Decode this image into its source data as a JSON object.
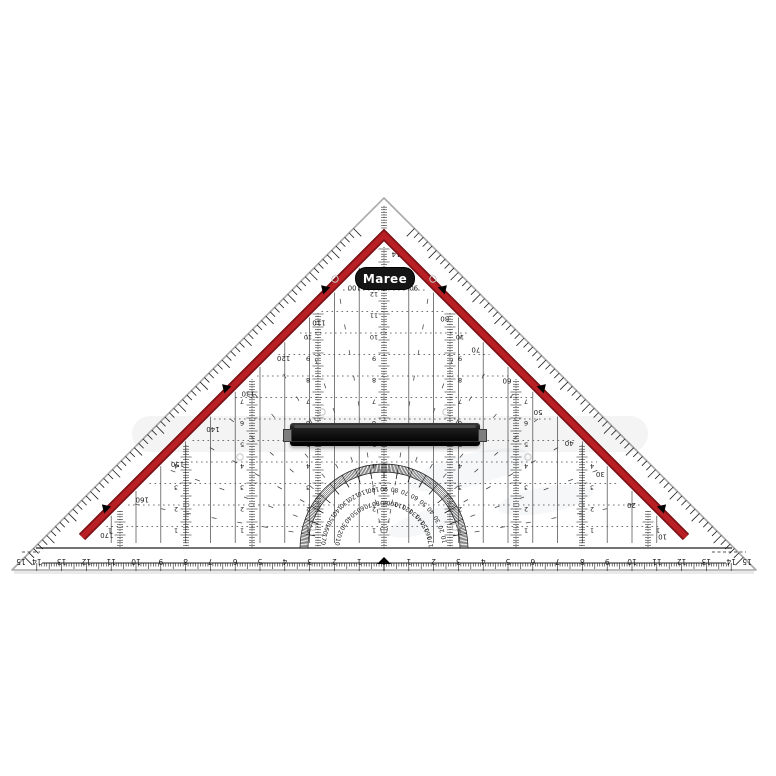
{
  "scene": {
    "background": "#ffffff",
    "description": "Transparent Maree geometry set square (protractor triangle) with black removable handle on white background"
  },
  "logo": {
    "text": "Maree",
    "bg": "#151515",
    "fg": "#ffffff"
  },
  "colors": {
    "band_red": "#b92025",
    "band_red_dark": "#7c1014",
    "print": "#1c1c1c",
    "print_soft": "#454545",
    "plastic_edge": "#a9a9a9",
    "handle": "#141414",
    "shadow": "#e3e3e3",
    "circle": "#c4c4c4"
  },
  "hypotenuse_ruler": {
    "unit": "cm",
    "numbers": [
      15,
      14,
      13,
      12,
      11,
      10,
      9,
      8,
      7,
      6,
      5,
      4,
      3,
      2,
      1,
      0,
      1,
      2,
      3,
      4,
      5,
      6,
      7,
      8,
      9,
      10,
      11,
      12,
      13,
      14,
      15
    ],
    "zero_marker": true
  },
  "leg_scales": {
    "right_labels": [
      90,
      80,
      70,
      60,
      50,
      40,
      30,
      20,
      10
    ],
    "left_labels": [
      100,
      110,
      120,
      130,
      140,
      150,
      160,
      170
    ]
  },
  "protractor": {
    "outer_scale": [
      10,
      20,
      30,
      40,
      50,
      60,
      70,
      80,
      90,
      100,
      110,
      120,
      130,
      140,
      150,
      160,
      170
    ],
    "inner_scale": [
      170,
      160,
      150,
      140,
      130,
      120,
      110,
      100,
      90,
      80,
      70,
      60,
      50,
      40,
      30,
      20,
      10
    ]
  },
  "grid": {
    "column_unit": "cm",
    "row_labels": [
      1,
      2,
      3,
      4,
      5,
      6,
      7,
      8,
      9,
      10,
      11,
      12,
      13
    ],
    "apex_label": "14",
    "ray_angles_deg": [
      10,
      20,
      30,
      40,
      50,
      60,
      70,
      80,
      100,
      110,
      120,
      130,
      140,
      150,
      160,
      170
    ]
  }
}
